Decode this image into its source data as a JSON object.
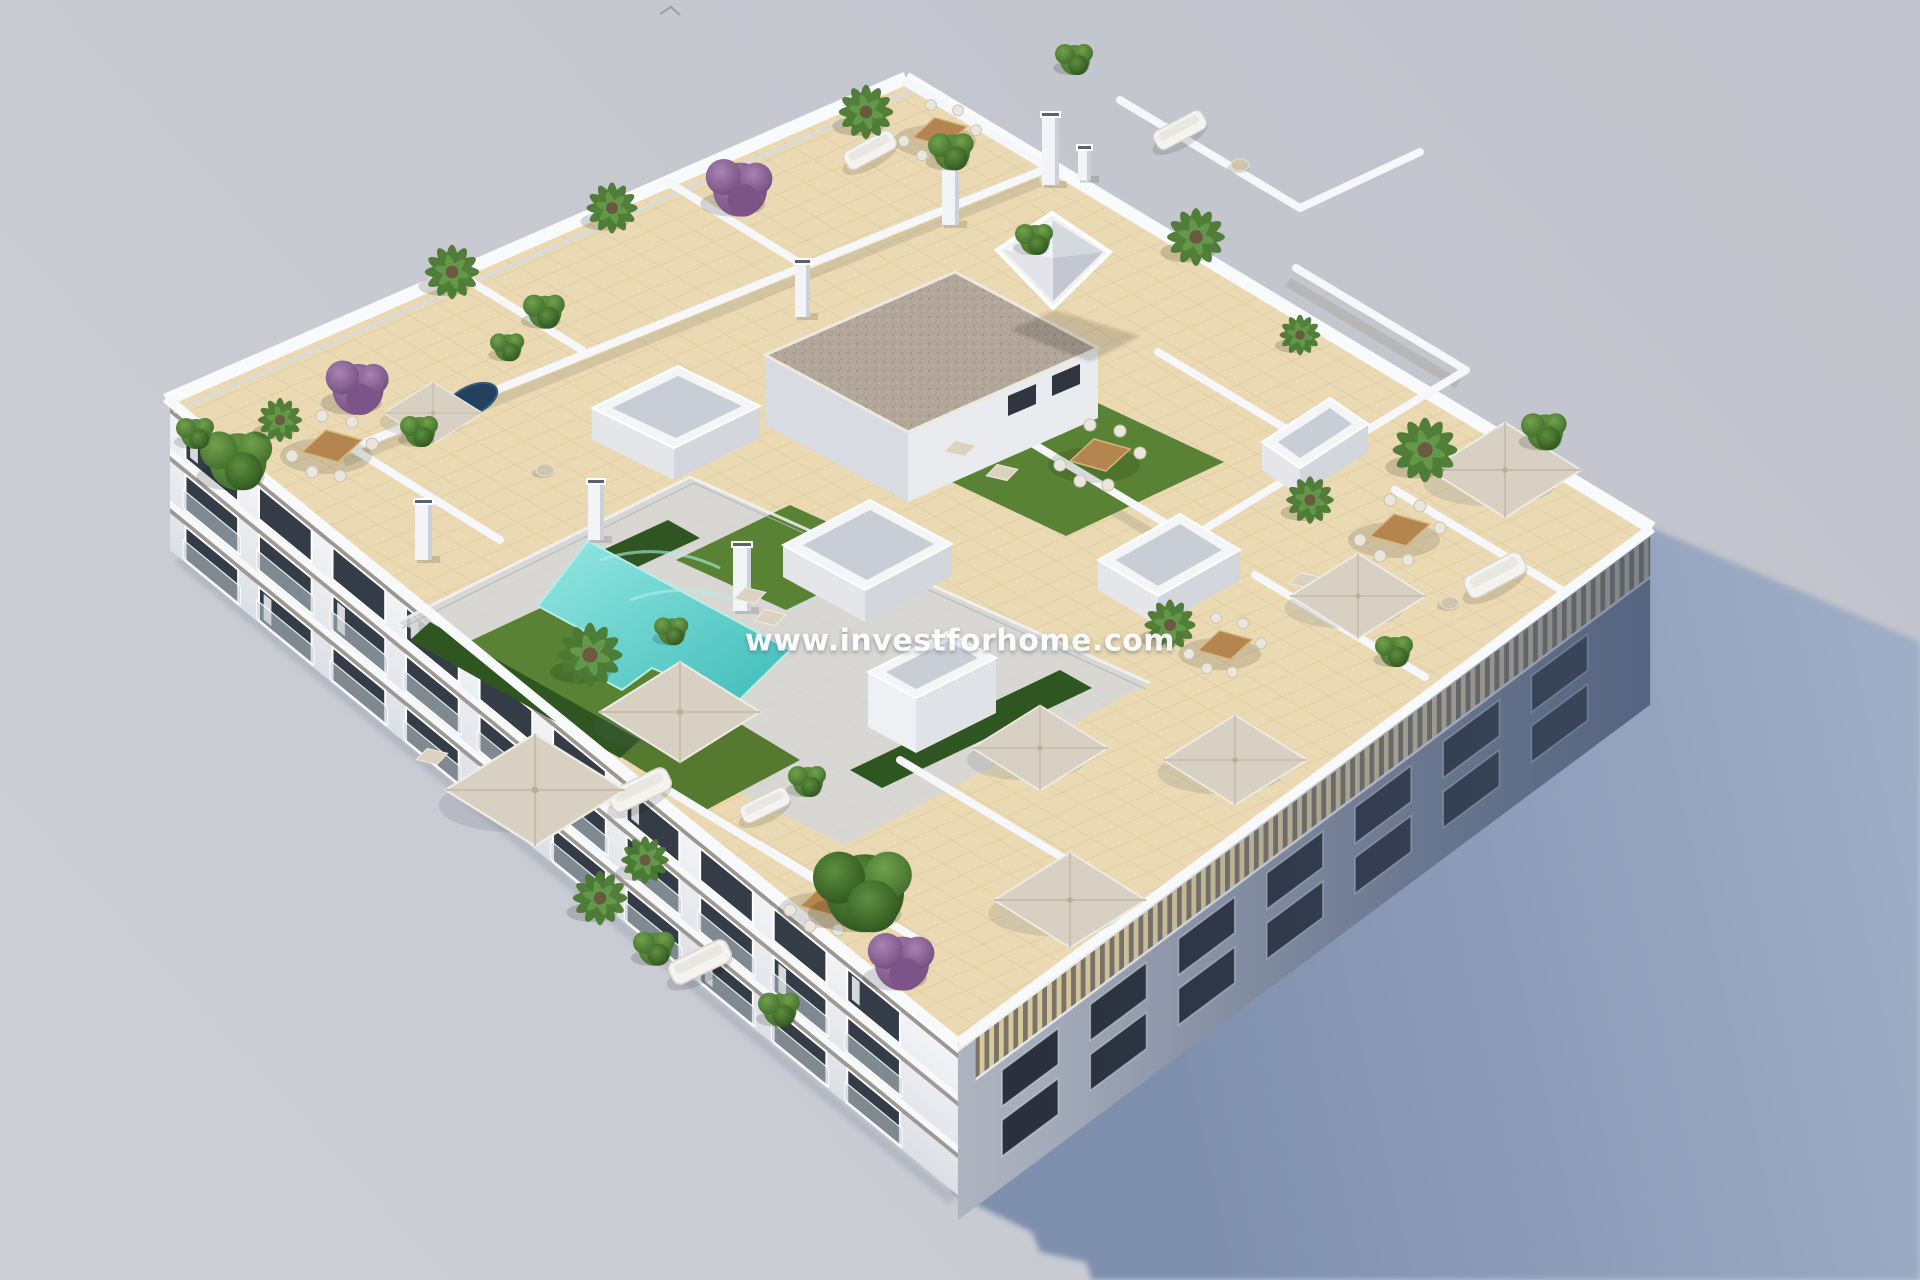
{
  "watermark": {
    "text": "www.investforhome.com"
  },
  "palette": {
    "background_top": "#c2c4cd",
    "background_bottom": "#cdced5",
    "cast_shadow": "#8b9bb8",
    "building_white": "#f2f3f6",
    "facade_shade_near": "#adb3bf",
    "facade_shade_far": "#6d7a94",
    "roof_tile": "#ead9b2",
    "tile_line": "#d9c69a",
    "pool_deck": "#d5d6d8",
    "pool_light": "#93e7e2",
    "pool": "#3fbcb8",
    "grass": "#5a8234",
    "hedge": "#2f5520",
    "plant": "#4f7d33",
    "plant_dark": "#35591f",
    "purple_plant": "#95699d",
    "wood": "#b5854f",
    "parasol": "#d8d1c3",
    "gravel_roof": "#b3a69a",
    "window_glass": "#343c47",
    "watermark_color": "#ffffff"
  }
}
